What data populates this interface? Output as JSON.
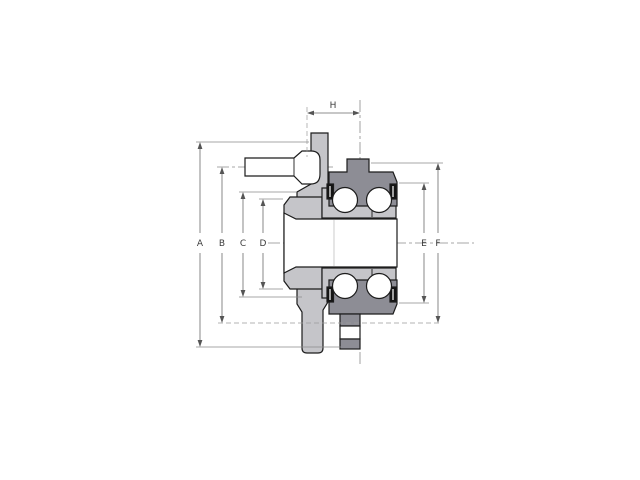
{
  "diagram": {
    "kind": "bearing-hub-cross-section",
    "labels": {
      "A": "A",
      "B": "B",
      "C": "C",
      "D": "D",
      "E": "E",
      "F": "F",
      "H": "H"
    }
  },
  "colors": {
    "background": "#ffffff",
    "hub_fill": "#c5c5c9",
    "race_fill": "#8d8d95",
    "white_fill": "#ffffff",
    "seal_fill": "#141414",
    "outline": "#1c1c1c"
  }
}
